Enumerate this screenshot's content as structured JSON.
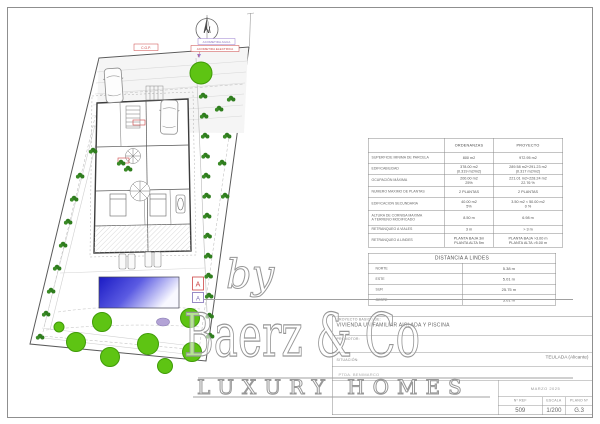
{
  "plan": {
    "north_label": "N",
    "utility_labels": {
      "cgp": "C.G.P.",
      "agua": "ACOMETIDA AGUA",
      "electrica": "ACOMETIDA ELECTRICA"
    },
    "section_marker_a": "A",
    "section_marker_b": "A",
    "colors": {
      "tree": "#5ec413",
      "tree_stroke": "#3f9b07",
      "shrub": "#2f7d1e",
      "pool_dark": "#1a1ac4",
      "pool_light": "#f8f8ff",
      "wall": "#3c3c3c",
      "marker_red": "#cc4444",
      "marker_purple": "#8a6fc0"
    }
  },
  "ordenanzas": {
    "col_ord": "ORDENANZAS",
    "col_proy": "PROYECTO",
    "rows": [
      {
        "label": "SUPERFICIE MINIMA DE PARCELA",
        "ord": "800 m2",
        "proy": "972.95 m2"
      },
      {
        "label": "EDIFICABILIDAD",
        "ord": "378.00 m2\n(0.319 m2/m2)",
        "proy": "289.58 m2+291.23 m2\n(0.317 m2/m2)"
      },
      {
        "label": "OCUPACIÓN MÁXIMA",
        "ord": "200.00 m2\n25%",
        "proy": "221.01 m2+228.24 m2\n22.76 %"
      },
      {
        "label": "NUMERO MAXIMO DE PLANTAS",
        "ord": "2 PLANTAS",
        "proy": "2 PLANTAS"
      },
      {
        "label": "EDIFICACION SECUNDARIA",
        "ord": "40.00 m2\n5%",
        "proy": "3.50 m2 < 50.00 m2\n0 %"
      },
      {
        "label": "ALTURA DE CORNISA MAXIMA\nA TERRENO MODIFICADO",
        "ord": "8.50 m",
        "proy": "6.98 m"
      },
      {
        "label": "RETRANQUEO A VIALES",
        "ord": "3 m",
        "proy": "> 3 m"
      },
      {
        "label": "RETRANQUEO A LINDES",
        "ord": "PLANTA BAJA 3m\nPLANTA ALTA 5m",
        "proy": "PLANTA BAJA >3.00 m\nPLANTA ALTA >5.00 m"
      }
    ]
  },
  "distancias": {
    "title": "DISTANCIA A LINDES",
    "rows": [
      {
        "side": "NORTE",
        "value": "5.38 m"
      },
      {
        "side": "ESTE",
        "value": "5.01 m"
      },
      {
        "side": "SUR",
        "value": "25.75 m"
      },
      {
        "side": "OESTE",
        "value": "5.01 m"
      }
    ]
  },
  "title_block": {
    "project_label": "PROYECTO BASICO DE:",
    "project_name": "VIVIENDA UNIFAMILIAR AISLADA Y PISCINA",
    "promotor_label": "PROMOTOR:",
    "situacion_label": "SITUACIÓN:",
    "situacion_value": "TEULADA (Alicante)",
    "address": "PTDA. BENIMARCO",
    "date": "MARZO 2025",
    "ref_label": "Nº REF",
    "ref_value": "509",
    "escala_label": "ESCALA",
    "escala_value": "1/200",
    "plano_label": "PLANO Nº",
    "plano_value": "G.3"
  },
  "watermark": {
    "by": "by",
    "brand": "Baerz & Co",
    "tagline": "LUXURY HOMES"
  }
}
